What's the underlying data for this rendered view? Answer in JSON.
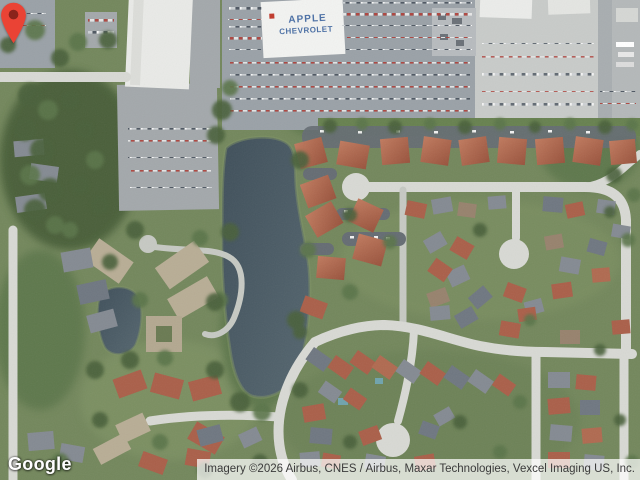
{
  "map": {
    "view_type": "satellite",
    "provider": {
      "logo_text": "Google"
    },
    "attribution": {
      "text": "Imagery ©2026 Airbus, CNES / Airbus, Maxar Technologies, Vexcel Imaging US, Inc.",
      "text_color": "#3b3b3b",
      "bg_color": "rgba(255,255,255,0.72)"
    },
    "marker": {
      "fill": "#EA4335",
      "dot": "#8A231B",
      "tip_x": 320,
      "tip_y": 249
    },
    "rooftop_label": {
      "line1": "APPLE",
      "line2": "CHEVROLET",
      "color": "#4a6fa5"
    },
    "palette": {
      "water": "#465661",
      "grass": "#73875c",
      "road": "#d8d9d4",
      "roof_red": "#aa5f49",
      "parking_lot": "#9aa1a7"
    }
  }
}
